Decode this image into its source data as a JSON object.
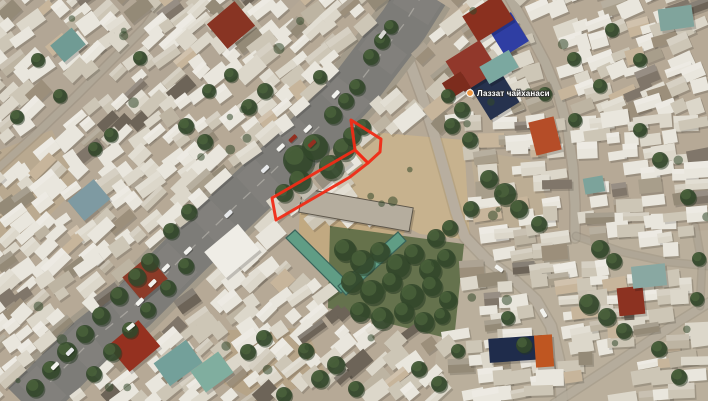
{
  "view": {
    "type": "satellite-map",
    "width": 708,
    "height": 401
  },
  "poi": {
    "label": "Лаззат чайханаси",
    "x": 477,
    "y": 96,
    "dot": {
      "x": 470,
      "y": 93,
      "r": 3.4,
      "color": "#f0953c",
      "ring": "#ffffff"
    }
  },
  "annotation": {
    "color": "#f52a14",
    "stroke_width": 3,
    "parcels": [
      {
        "name": "parcel-upper",
        "points": [
          [
            351,
            120
          ],
          [
            381,
            139
          ],
          [
            380,
            152
          ],
          [
            368,
            163
          ],
          [
            355,
            150
          ]
        ]
      },
      {
        "name": "parcel-strip",
        "points": [
          [
            355,
            150
          ],
          [
            368,
            163
          ],
          [
            350,
            177
          ],
          [
            276,
            220
          ],
          [
            272,
            198
          ]
        ]
      }
    ]
  },
  "seed": 7,
  "road": {
    "center": [
      [
        424,
        -8
      ],
      [
        404,
        24
      ],
      [
        381,
        54
      ],
      [
        352,
        92
      ],
      [
        322,
        124
      ],
      [
        295,
        150
      ],
      [
        268,
        176
      ],
      [
        243,
        199
      ],
      [
        215,
        226
      ],
      [
        188,
        252
      ],
      [
        160,
        280
      ],
      [
        134,
        306
      ],
      [
        110,
        326
      ],
      [
        92,
        340
      ],
      [
        70,
        362
      ],
      [
        47,
        385
      ],
      [
        26,
        406
      ]
    ],
    "asphalt": "#7d7c78",
    "shoulder": "#a29a8a",
    "texture": "#8b8a85",
    "line": "#c9c6bd",
    "half_width": 25
  },
  "streets": [
    {
      "name": "street-southeast",
      "pts": [
        [
          408,
          58
        ],
        [
          422,
          96
        ],
        [
          434,
          134
        ],
        [
          446,
          176
        ],
        [
          456,
          212
        ],
        [
          465,
          237
        ],
        [
          486,
          259
        ],
        [
          512,
          278
        ],
        [
          536,
          300
        ],
        [
          551,
          326
        ],
        [
          559,
          360
        ],
        [
          562,
          404
        ]
      ],
      "w": 10,
      "c": "#b7af9f",
      "op": 0.95
    },
    {
      "name": "street-northeast",
      "pts": [
        [
          509,
          -4
        ],
        [
          527,
          28
        ],
        [
          545,
          62
        ],
        [
          559,
          96
        ],
        [
          568,
          130
        ],
        [
          573,
          168
        ],
        [
          575,
          205
        ],
        [
          575,
          238
        ]
      ],
      "w": 9,
      "c": "#b5ad9d",
      "op": 0.9
    },
    {
      "name": "alley-topleft",
      "pts": [
        [
          -4,
          170
        ],
        [
          34,
          136
        ],
        [
          76,
          96
        ],
        [
          114,
          58
        ],
        [
          146,
          26
        ],
        [
          162,
          4
        ]
      ],
      "w": 7,
      "c": "#b3aa9a",
      "op": 0.8
    },
    {
      "name": "alley-right",
      "pts": [
        [
          576,
          236
        ],
        [
          622,
          252
        ],
        [
          668,
          262
        ],
        [
          708,
          266
        ]
      ],
      "w": 6,
      "c": "#b3aa9a",
      "op": 0.6
    },
    {
      "name": "alley-bottomright",
      "pts": [
        [
          554,
          404
        ],
        [
          612,
          366
        ],
        [
          678,
          322
        ],
        [
          710,
          302
        ]
      ],
      "w": 8,
      "c": "#b6ae9e",
      "op": 0.85
    },
    {
      "name": "alley-rightedge",
      "pts": [
        [
          695,
          226
        ],
        [
          702,
          264
        ],
        [
          700,
          306
        ]
      ],
      "w": 6,
      "c": "#b3aa9a",
      "op": 0.6
    }
  ],
  "ground": {
    "base": "#b6a995",
    "patches": [
      {
        "poly": [
          [
            0,
            0
          ],
          [
            300,
            0
          ],
          [
            180,
            120
          ],
          [
            0,
            200
          ]
        ],
        "fill": "#a7a195",
        "op": 0.25
      },
      {
        "poly": [
          [
            450,
            250
          ],
          [
            708,
            230
          ],
          [
            708,
            401
          ],
          [
            430,
            401
          ]
        ],
        "fill": "#cec6b4",
        "op": 0.2
      },
      {
        "poly": [
          [
            348,
            130
          ],
          [
            464,
            140
          ],
          [
            470,
            240
          ],
          [
            420,
            234
          ],
          [
            352,
            200
          ]
        ],
        "fill": "#c9b28c",
        "op": 0.95
      },
      {
        "poly": [
          [
            300,
            208
          ],
          [
            408,
            226
          ],
          [
            400,
            240
          ],
          [
            344,
            284
          ],
          [
            298,
            250
          ]
        ],
        "fill": "#c3a97e",
        "op": 0.95
      },
      {
        "poly": [
          [
            330,
            226
          ],
          [
            464,
            244
          ],
          [
            454,
            340
          ],
          [
            328,
            308
          ]
        ],
        "fill": "#5c6b44",
        "op": 0.9
      },
      {
        "poly": [
          [
            228,
            330
          ],
          [
            306,
            328
          ],
          [
            326,
            374
          ],
          [
            262,
            404
          ],
          [
            224,
            384
          ]
        ],
        "fill": "#b7a17e",
        "op": 0.6
      },
      {
        "poly": [
          [
            0,
            150
          ],
          [
            52,
            130
          ],
          [
            78,
            186
          ],
          [
            34,
            232
          ],
          [
            0,
            238
          ]
        ],
        "fill": "#bfab8b",
        "op": 0.55
      },
      {
        "poly": [
          [
            470,
            150
          ],
          [
            530,
            160
          ],
          [
            560,
            230
          ],
          [
            480,
            225
          ]
        ],
        "fill": "#c2b192",
        "op": 0.5
      }
    ]
  },
  "avoid_zones": [
    [
      [
        348,
        130
      ],
      [
        464,
        140
      ],
      [
        470,
        240
      ],
      [
        420,
        234
      ],
      [
        352,
        202
      ]
    ],
    [
      [
        282,
        226
      ],
      [
        412,
        224
      ],
      [
        408,
        256
      ],
      [
        350,
        300
      ],
      [
        284,
        254
      ]
    ],
    [
      [
        330,
        226
      ],
      [
        464,
        244
      ],
      [
        454,
        340
      ],
      [
        328,
        308
      ]
    ]
  ],
  "landmarks": [
    {
      "x": 478,
      "y": 76,
      "w": 34,
      "h": 38,
      "rot": -32,
      "fill": "#26324f"
    },
    {
      "x": 494,
      "y": 17,
      "w": 28,
      "h": 34,
      "rot": -32,
      "fill": "#2e3ea6"
    },
    {
      "x": 467,
      "y": 3,
      "w": 42,
      "h": 30,
      "rot": -32,
      "fill": "#8c2f1e"
    },
    {
      "x": 452,
      "y": 48,
      "w": 40,
      "h": 36,
      "rot": -32,
      "fill": "#93372a"
    },
    {
      "x": 445,
      "y": 76,
      "w": 22,
      "h": 18,
      "rot": -32,
      "fill": "#7e2c1c"
    },
    {
      "x": 532,
      "y": 119,
      "w": 26,
      "h": 34,
      "rot": -14,
      "fill": "#b84c26"
    },
    {
      "x": 618,
      "y": 287,
      "w": 26,
      "h": 28,
      "rot": -6,
      "fill": "#8e3120"
    },
    {
      "x": 114,
      "y": 329,
      "w": 40,
      "h": 34,
      "rot": -40,
      "fill": "#97301f"
    },
    {
      "x": 128,
      "y": 263,
      "w": 34,
      "h": 30,
      "rot": -40,
      "fill": "#8e3b27"
    },
    {
      "x": 213,
      "y": 9,
      "w": 36,
      "h": 32,
      "rot": -40,
      "fill": "#8a3322"
    },
    {
      "x": 54,
      "y": 34,
      "w": 28,
      "h": 22,
      "rot": -40,
      "fill": "#6f9b94"
    },
    {
      "x": 482,
      "y": 57,
      "w": 34,
      "h": 20,
      "rot": -30,
      "fill": "#7aa8a0"
    },
    {
      "x": 158,
      "y": 349,
      "w": 40,
      "h": 28,
      "rot": -36,
      "fill": "#72a09a"
    },
    {
      "x": 195,
      "y": 359,
      "w": 34,
      "h": 26,
      "rot": -36,
      "fill": "#7fae9f"
    },
    {
      "x": 632,
      "y": 265,
      "w": 34,
      "h": 22,
      "rot": -6,
      "fill": "#88a8a2"
    },
    {
      "x": 659,
      "y": 7,
      "w": 34,
      "h": 22,
      "rot": -8,
      "fill": "#7fa49c"
    },
    {
      "x": 584,
      "y": 177,
      "w": 20,
      "h": 16,
      "rot": -10,
      "fill": "#7ba39b"
    },
    {
      "x": 489,
      "y": 337,
      "w": 54,
      "h": 24,
      "rot": -4,
      "fill": "#1f2c4c"
    },
    {
      "x": 535,
      "y": 335,
      "w": 18,
      "h": 32,
      "rot": -4,
      "fill": "#c2551f"
    },
    {
      "x": 300,
      "y": 198,
      "w": 112,
      "h": 24,
      "rot": 10,
      "fill": "#b5ad9e",
      "stroke": "#5d564a"
    },
    {
      "x": 210,
      "y": 234,
      "w": 44,
      "h": 34,
      "rot": -40,
      "fill": "#efede6"
    },
    {
      "x": 72,
      "y": 187,
      "w": 34,
      "h": 26,
      "rot": -40,
      "fill": "#7d9aa2"
    },
    {
      "x": 258,
      "y": 226,
      "w": 26,
      "h": 18,
      "rot": -40,
      "fill": "#e8e5dc"
    },
    {
      "x": 280,
      "y": 195,
      "w": 20,
      "h": 14,
      "rot": -40,
      "fill": "#b3ab9c"
    },
    {
      "x": 298,
      "y": 183,
      "w": 18,
      "h": 13,
      "rot": -40,
      "fill": "#c5bfb2"
    },
    {
      "x": 316,
      "y": 171,
      "w": 18,
      "h": 13,
      "rot": -40,
      "fill": "#978f80"
    },
    {
      "x": 334,
      "y": 157,
      "w": 16,
      "h": 12,
      "rot": -40,
      "fill": "#c0b9aa"
    },
    {
      "x": 354,
      "y": 126,
      "w": 22,
      "h": 16,
      "rot": -40,
      "fill": "#d8d3c8"
    }
  ],
  "school": {
    "wing1": [
      [
        286,
        238
      ],
      [
        295,
        230
      ],
      [
        350,
        284
      ],
      [
        341,
        293
      ]
    ],
    "wing2": [
      [
        346,
        295
      ],
      [
        338,
        286
      ],
      [
        398,
        232
      ],
      [
        406,
        241
      ]
    ],
    "fill": "#5f9d85",
    "stroke": "#39645a"
  },
  "trees": [
    [
      298,
      160,
      15
    ],
    [
      315,
      147,
      13
    ],
    [
      331,
      167,
      12
    ],
    [
      344,
      149,
      11
    ],
    [
      300,
      181,
      11
    ],
    [
      284,
      193,
      9
    ],
    [
      352,
      136,
      9
    ],
    [
      363,
      127,
      8
    ],
    [
      382,
      41,
      8
    ],
    [
      371,
      57,
      8
    ],
    [
      391,
      27,
      7
    ],
    [
      357,
      87,
      8
    ],
    [
      346,
      101,
      8
    ],
    [
      333,
      115,
      9
    ],
    [
      320,
      77,
      7
    ],
    [
      150,
      262,
      9
    ],
    [
      137,
      277,
      9
    ],
    [
      119,
      296,
      9
    ],
    [
      101,
      316,
      9
    ],
    [
      85,
      334,
      9
    ],
    [
      67,
      352,
      10
    ],
    [
      51,
      370,
      9
    ],
    [
      35,
      388,
      9
    ],
    [
      171,
      231,
      8
    ],
    [
      189,
      212,
      8
    ],
    [
      186,
      266,
      8
    ],
    [
      168,
      288,
      8
    ],
    [
      148,
      310,
      8
    ],
    [
      130,
      330,
      8
    ],
    [
      112,
      352,
      9
    ],
    [
      94,
      374,
      8
    ],
    [
      345,
      250,
      11
    ],
    [
      362,
      262,
      12
    ],
    [
      380,
      252,
      10
    ],
    [
      398,
      266,
      12
    ],
    [
      414,
      254,
      10
    ],
    [
      430,
      270,
      11
    ],
    [
      446,
      258,
      9
    ],
    [
      352,
      282,
      11
    ],
    [
      372,
      292,
      12
    ],
    [
      392,
      282,
      10
    ],
    [
      412,
      296,
      12
    ],
    [
      432,
      286,
      10
    ],
    [
      448,
      300,
      9
    ],
    [
      360,
      312,
      10
    ],
    [
      382,
      318,
      11
    ],
    [
      404,
      312,
      10
    ],
    [
      424,
      322,
      10
    ],
    [
      442,
      316,
      8
    ],
    [
      436,
      238,
      9
    ],
    [
      450,
      228,
      8
    ],
    [
      489,
      179,
      9
    ],
    [
      505,
      194,
      11
    ],
    [
      519,
      209,
      9
    ],
    [
      539,
      224,
      8
    ],
    [
      471,
      209,
      8
    ],
    [
      600,
      249,
      9
    ],
    [
      614,
      261,
      8
    ],
    [
      589,
      304,
      10
    ],
    [
      607,
      317,
      9
    ],
    [
      624,
      331,
      8
    ],
    [
      574,
      59,
      7
    ],
    [
      545,
      94,
      7
    ],
    [
      688,
      197,
      8
    ],
    [
      699,
      259,
      7
    ],
    [
      659,
      349,
      8
    ],
    [
      679,
      377,
      8
    ],
    [
      697,
      299,
      7
    ],
    [
      524,
      345,
      8
    ],
    [
      508,
      318,
      7
    ],
    [
      320,
      379,
      9
    ],
    [
      336,
      365,
      9
    ],
    [
      356,
      389,
      8
    ],
    [
      306,
      351,
      8
    ],
    [
      419,
      369,
      8
    ],
    [
      439,
      384,
      8
    ],
    [
      458,
      351,
      7
    ],
    [
      284,
      395,
      8
    ],
    [
      248,
      352,
      8
    ],
    [
      264,
      338,
      8
    ],
    [
      95,
      149,
      7
    ],
    [
      111,
      135,
      7
    ],
    [
      17,
      117,
      7
    ],
    [
      209,
      91,
      7
    ],
    [
      231,
      75,
      7
    ],
    [
      249,
      107,
      8
    ],
    [
      265,
      91,
      8
    ],
    [
      60,
      96,
      7
    ],
    [
      38,
      60,
      7
    ],
    [
      140,
      58,
      7
    ],
    [
      186,
      126,
      8
    ],
    [
      205,
      142,
      8
    ],
    [
      448,
      96,
      7
    ],
    [
      462,
      110,
      8
    ],
    [
      452,
      126,
      8
    ],
    [
      470,
      140,
      8
    ],
    [
      612,
      30,
      7
    ],
    [
      640,
      60,
      7
    ],
    [
      600,
      86,
      7
    ],
    [
      575,
      120,
      7
    ],
    [
      660,
      160,
      8
    ],
    [
      640,
      130,
      7
    ]
  ],
  "palette": {
    "house": [
      "#e9e6dd",
      "#dcd7ca",
      "#cdc6b6",
      "#bdb4a1",
      "#a89e8a",
      "#948a76",
      "#80766a",
      "#c7b59a",
      "#6d6458",
      "#9c8f7a"
    ],
    "car": [
      "#f2f2ee",
      "#f2f2ee",
      "#f2f2ee",
      "#e6e8ea",
      "#d9d9d4",
      "#c7c7c2",
      "#3a3a38",
      "#952e20"
    ],
    "tree_base": "#33482a",
    "tree_light": "#4d653c",
    "tree_dark": "#243620"
  },
  "counts": {
    "cars_main": 15,
    "cars_branch": 2,
    "shrubs": 42
  }
}
